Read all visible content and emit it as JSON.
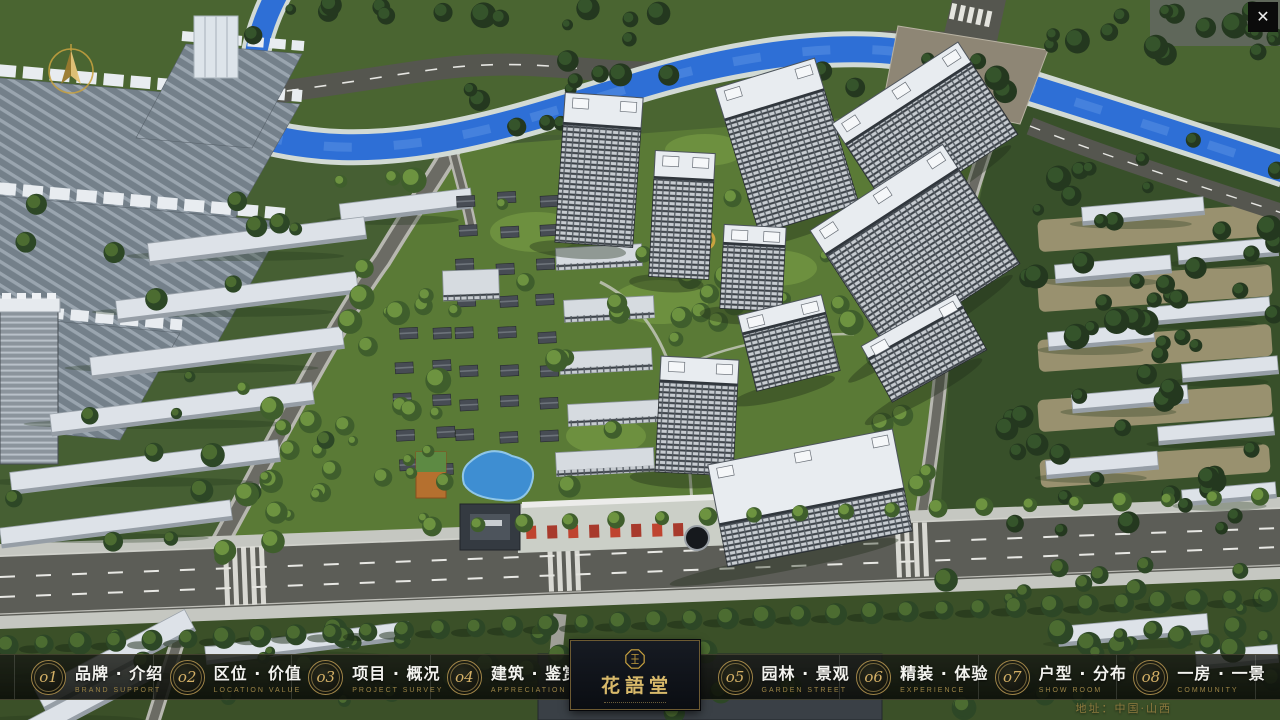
{
  "window": {
    "close_button": "✕",
    "address": "地址：中国·山西"
  },
  "logo": {
    "title": "花語堂"
  },
  "menu": {
    "items": [
      {
        "num": "o1",
        "label_zh": "品牌 · 介绍",
        "label_en": "BRAND SUPPORT"
      },
      {
        "num": "o2",
        "label_zh": "区位 · 价值",
        "label_en": "LOCATION VALUE"
      },
      {
        "num": "o3",
        "label_zh": "项目 · 概况",
        "label_en": "PROJECT SURVEY"
      },
      {
        "num": "o4",
        "label_zh": "建筑 · 鉴赏",
        "label_en": "APPRECIATION"
      },
      {
        "num": "o5",
        "label_zh": "园林 · 景观",
        "label_en": "GARDEN STREET"
      },
      {
        "num": "o6",
        "label_zh": "精装 · 体验",
        "label_en": "EXPERIENCE"
      },
      {
        "num": "o7",
        "label_zh": "户型 · 分布",
        "label_en": "SHOW ROOM"
      },
      {
        "num": "o8",
        "label_zh": "一房 · 一景",
        "label_en": "COMMUNITY"
      }
    ]
  },
  "scene_colors": {
    "water": "#2e6fd6",
    "accent_gold": "#c9a23f",
    "tree_dark": "#2d4726",
    "roof_white": "#e8ecf0",
    "road": "#5c5d57",
    "lawn": "#5a7a36"
  }
}
